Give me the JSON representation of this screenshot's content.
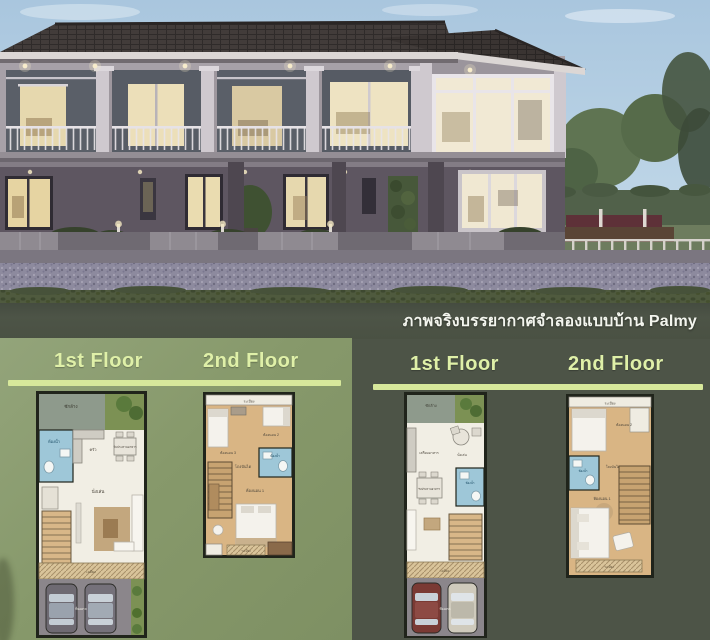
{
  "caption": {
    "text": "ภาพจริงบรรยากาศจำลองแบบบ้าน Palmy"
  },
  "panels": {
    "left": {
      "floor1_label": "1st Floor",
      "floor2_label": "2nd Floor"
    },
    "right": {
      "floor1_label": "1st Floor",
      "floor2_label": "2nd Floor"
    }
  },
  "plans": {
    "left_floor1": {
      "rooms": {
        "laundry": "ซักล้าง",
        "bath": "ห้องน้ำ",
        "kitchen": "ครัว",
        "dining": "รับประทานอาหาร",
        "living": "นั่งเล่น",
        "terrace": "เฉลียง",
        "carport": "ที่จอดรถ"
      }
    },
    "left_floor2": {
      "rooms": {
        "balcony_top": "ระเบียง",
        "bedroom3": "ห้องนอน 3",
        "bedroom2": "ห้องนอน 2",
        "bath": "ห้องน้ำ",
        "hall": "โถงบันได",
        "bedroom1": "ห้องนอน 1",
        "balcony_bottom": "ระเบียง"
      }
    },
    "right_floor1": {
      "rooms": {
        "laundry": "ซักล้าง",
        "prep": "เตรียมอาหาร",
        "living": "นั่งเล่น",
        "bath": "ห้องน้ำ",
        "dining": "รับประทานอาหาร",
        "terrace": "เฉลียง",
        "carport": "ที่จอดรถ"
      }
    },
    "right_floor2": {
      "rooms": {
        "balcony_top": "ระเบียง",
        "bedroom2": "ห้องนอน 2",
        "bath": "ห้องน้ำ",
        "hall": "โถงบันได",
        "bedroom1": "ห้องนอน 1",
        "balcony_bottom": "ระเบียง"
      }
    }
  },
  "colors": {
    "panel_left_bg": "#87996b",
    "panel_right_bg": "#485a3b",
    "caption_band_bg": "#4d5447",
    "header_text": "#dff0a8",
    "header_bar": "#d7e89b",
    "plan_floor": "#f1eee4",
    "plan_wood": "#d9b584",
    "plan_bath": "#9ec7d8",
    "plan_border": "#20241b"
  }
}
